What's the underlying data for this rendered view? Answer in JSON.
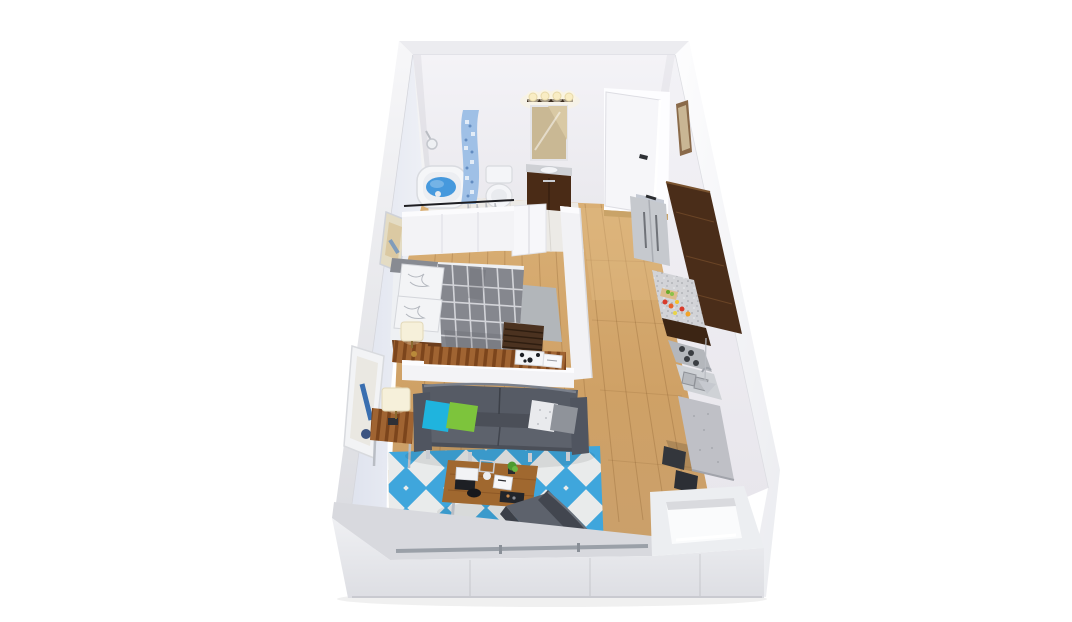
{
  "meta": {
    "canvas_width": 1072,
    "canvas_height": 622,
    "view": "isometric-3d-floor-plan",
    "unit_type": "studio-apartment"
  },
  "rooms": {
    "bathroom": {
      "label": "bathroom",
      "items": [
        "bathtub",
        "shower-head",
        "shower-curtain",
        "toilet",
        "vanity-sink",
        "mirror",
        "vanity-lights"
      ]
    },
    "closet": {
      "label": "closet",
      "items": [
        "clothes-rail",
        "hangers",
        "garments",
        "black-vase",
        "white-cabinet"
      ]
    },
    "bedroom": {
      "label": "bedroom",
      "items": [
        "double-bed",
        "grid-duvet",
        "pillows",
        "nightstand",
        "table-lamp",
        "wood-bench",
        "wall-art"
      ]
    },
    "living_room": {
      "label": "living-room",
      "items": [
        "leather-sofa",
        "accent-pillows",
        "coffee-table",
        "diamond-rug",
        "armchair",
        "side-table",
        "table-lamp",
        "wall-art"
      ]
    },
    "kitchen": {
      "label": "kitchen",
      "items": [
        "refrigerator",
        "wall-cabinets",
        "countertop-with-food",
        "cooktop",
        "double-sink",
        "breakfast-bar",
        "bar-stools",
        "pendant-lamp"
      ]
    },
    "hallway": {
      "label": "hallway",
      "items": [
        "entry-door",
        "wood-flooring",
        "gray-runner-rug",
        "entry-nook"
      ]
    }
  },
  "colors": {
    "page_bg": "#ffffff",
    "wall_back": "#f1f0f4",
    "wall_left": "#e6e9f2",
    "wall_right": "#efeef3",
    "wall_outer_left": "#ededf1",
    "wall_outer_right": "#f7f7fa",
    "wall_top_rim": "#ececf0",
    "partition_white": "#f3f3f6",
    "bottom_wall": "#e6e7eb",
    "bottom_wall_top": "#d8d9de",
    "rail_gray": "#9aa0a8",
    "floor_wood": "#d2a76e",
    "floor_wood_light": "#e3c18f",
    "floor_bathroom": "#eceae6",
    "rug_blue": "#3fa6dc",
    "rug_white": "#e9ebeb",
    "rug_gray": "#b2b6ba",
    "sofa_dark": "#4b4f58",
    "sofa_back": "#565b65",
    "sofa_seat": "#5d626c",
    "armchair_dark": "#42464f",
    "pillow_cyan": "#1fb4de",
    "pillow_green": "#7dc43c",
    "pillow_white": "#e9eaed",
    "pillow_gray": "#8f939a",
    "duvet_gray": "#85878e",
    "bed_pillow_white": "#f3f4f6",
    "bed_platform_wood": "#6b3d1d",
    "table_wood": "#a0682f",
    "stripe_wood": "#9a5f2c",
    "cabinet_brown": "#4a2d19",
    "cabinet_brown_dark": "#3c2514",
    "counter_granite": "#cfd0d4",
    "fridge_steel": "#c6c9ce",
    "bar_granite": "#bfc0c6",
    "stool_dark": "#33363c",
    "tub_white": "#f5f6f8",
    "water_blue": "#4699dd",
    "curtain_blue": "#9fc0e6",
    "toilet_white": "#f4f5f8",
    "vanity_brown": "#4a2b16",
    "mirror_wood": "#c9b894",
    "bulb_warm": "#f9edc4",
    "door_white": "#f6f6f9",
    "lamp_shade": "#f6f0da",
    "frame_beige": "#e4dcc4",
    "art_blue": "#3a6fb0"
  }
}
